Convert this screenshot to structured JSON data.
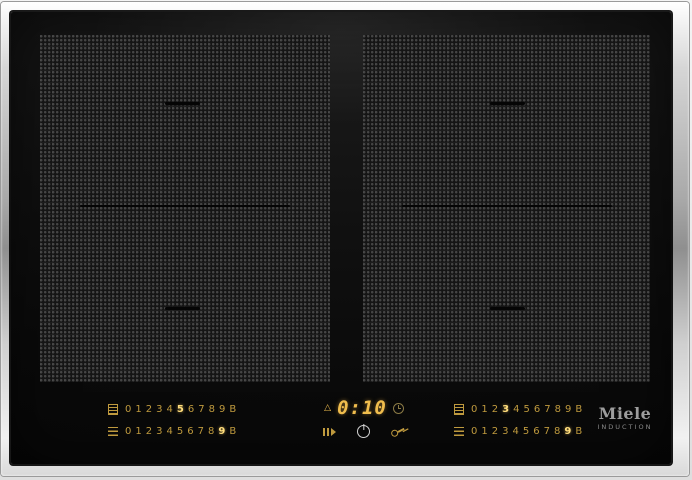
{
  "colors": {
    "amber": "#bf9a3e",
    "amber_bright": "#ffdd7c",
    "display_amber": "#f0bd4d",
    "logo_grey": "#9d9d9d",
    "glass_black": "#0b0b0b",
    "frame_silver": "#d6d6d6"
  },
  "brand": {
    "name": "Miele",
    "tagline": "INDUCTION"
  },
  "timer": {
    "value": "0:10",
    "left_icon": "minute-minder-icon",
    "right_icon": "timer-clock-icon"
  },
  "selectors": {
    "left": {
      "rows": [
        {
          "icon": "rear-zone-icon",
          "digits": [
            "0",
            "1",
            "2",
            "3",
            "4",
            "5",
            "6",
            "7",
            "8",
            "9",
            "B"
          ],
          "active_index": 5
        },
        {
          "icon": "front-zone-icon",
          "digits": [
            "0",
            "1",
            "2",
            "3",
            "4",
            "5",
            "6",
            "7",
            "8",
            "9",
            "B"
          ],
          "active_index": 9
        }
      ]
    },
    "right": {
      "rows": [
        {
          "icon": "rear-zone-icon",
          "digits": [
            "0",
            "1",
            "2",
            "3",
            "4",
            "5",
            "6",
            "7",
            "8",
            "9",
            "B"
          ],
          "active_index": 3
        },
        {
          "icon": "front-zone-icon",
          "digits": [
            "0",
            "1",
            "2",
            "3",
            "4",
            "5",
            "6",
            "7",
            "8",
            "9",
            "B"
          ],
          "active_index": 9
        }
      ]
    }
  },
  "buttons": {
    "recall": "recall-icon",
    "power": "power-icon",
    "lock": "lock-icon"
  },
  "glyphs": {
    "minute_minder": "△"
  }
}
